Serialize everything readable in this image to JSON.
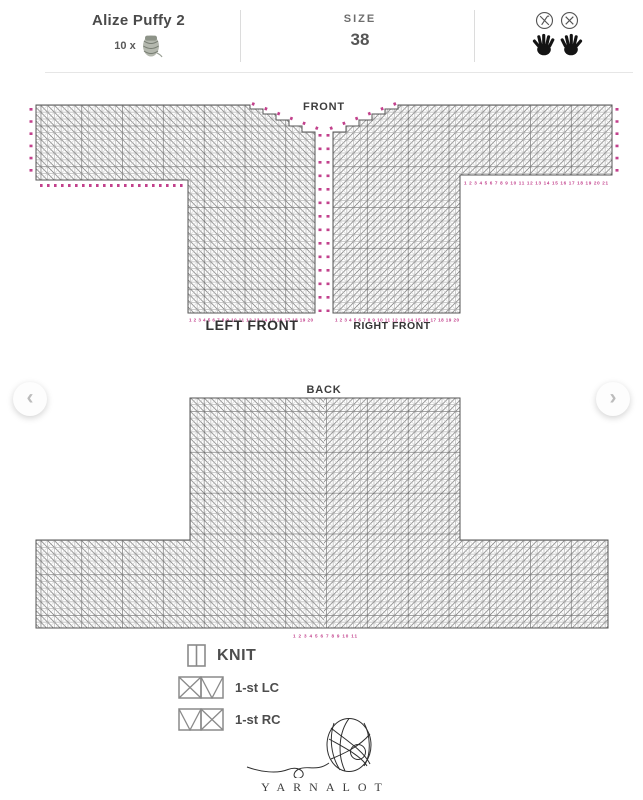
{
  "header": {
    "yarn_name": "Alize Puffy 2",
    "yarn_quantity": "10 x",
    "size_label": "SIZE",
    "size_value": "38",
    "icons": [
      "yarn-skein-icon",
      "no-crochet-hook-icon",
      "no-knitting-needles-icon",
      "left-hand-icon",
      "right-hand-icon"
    ]
  },
  "carousel": {
    "prev_icon": "‹",
    "next_icon": "›"
  },
  "front_chart": {
    "title": "FRONT",
    "left_piece_label": "LEFT FRONT",
    "right_piece_label": "RIGHT FRONT",
    "left_bottom_numbers": "1 2 3 4 5 6 7 8 9 10 11 12 13 14 15 16 17 18 19 20",
    "right_bottom_numbers": "1 2 3 4 5 6 7 8 9 10 11 12 13 14 15 16 17 18 19 20",
    "right_sleeve_numbers": "1 2 3 4 5 6 7 8 9 10 11 12 13 14 15 16 17 18 19 20 21"
  },
  "back_chart": {
    "title": "BACK",
    "bottom_numbers": "1 2 3 4 5 6 7 8 9 10 11"
  },
  "legend": {
    "knit_label": "KNIT",
    "lc_label": "1-st LC",
    "rc_label": "1-st RC"
  },
  "footer": {
    "brand": "YARNALOT"
  },
  "colors": {
    "accent_pink": "#c2418c",
    "grid_gray": "#9b9b9b",
    "outline_gray": "#555555",
    "text_dark": "#4a4a4a"
  }
}
